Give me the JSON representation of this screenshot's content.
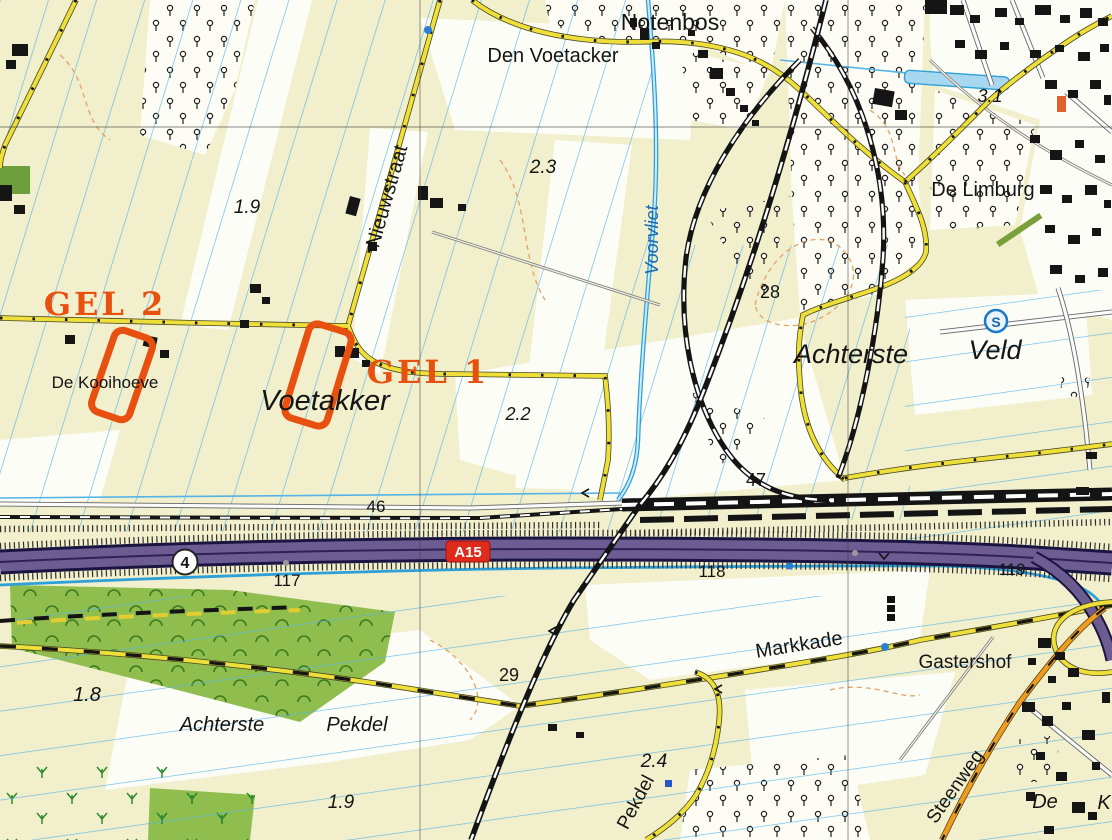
{
  "map": {
    "description": "Topographic map extract with two orange survey-site annotations near the A15 motorway and a railway junction",
    "colors": {
      "annotation_orange": "#e8500f",
      "motorway_purple": "#6c5c92",
      "road_yellow": "#efdf3a",
      "road_orange": "#ef9b1e",
      "water_blue": "#2da0d8",
      "field_base": "#f1efcc",
      "meadow_green": "#8fbe4e",
      "rail_black": "#141414",
      "a15_shield_red": "#dd2b1c"
    }
  },
  "places": {
    "notenbos": "Notenbos",
    "den_voetacker": "Den Voetacker",
    "nieuwstraat": "Nieuwstraat",
    "voorvliet": "Voorvliet",
    "de_limburg": "De Limburg",
    "achterste": "Achterste",
    "veld": "Veld",
    "de_kooihoeve": "De Kooihoeve",
    "voetakker": "Voetakker",
    "markkade": "Markkade",
    "gastershof": "Gastershof",
    "achterste2": "Achterste",
    "pekdel": "Pekdel",
    "pekdel_road": "Pekdel",
    "steenweg": "Steenweg",
    "de_fragment": "De",
    "k_fragment": "K"
  },
  "annotations": {
    "gel1": "GEL 1",
    "gel2": "GEL 2"
  },
  "road_signs": {
    "a15": "A15",
    "exit": "4"
  },
  "symbols": {
    "s": "S"
  },
  "numbers": {
    "n19_top": "1.9",
    "n23": "2.3",
    "n31": "3.1",
    "n22": "2.2",
    "n28": "28",
    "n46": "46",
    "n47": "47",
    "n117": "117",
    "n118": "118",
    "n119": "119",
    "n29": "29",
    "n18": "1.8",
    "n24": "2.4",
    "n19_bot": "1.9"
  }
}
